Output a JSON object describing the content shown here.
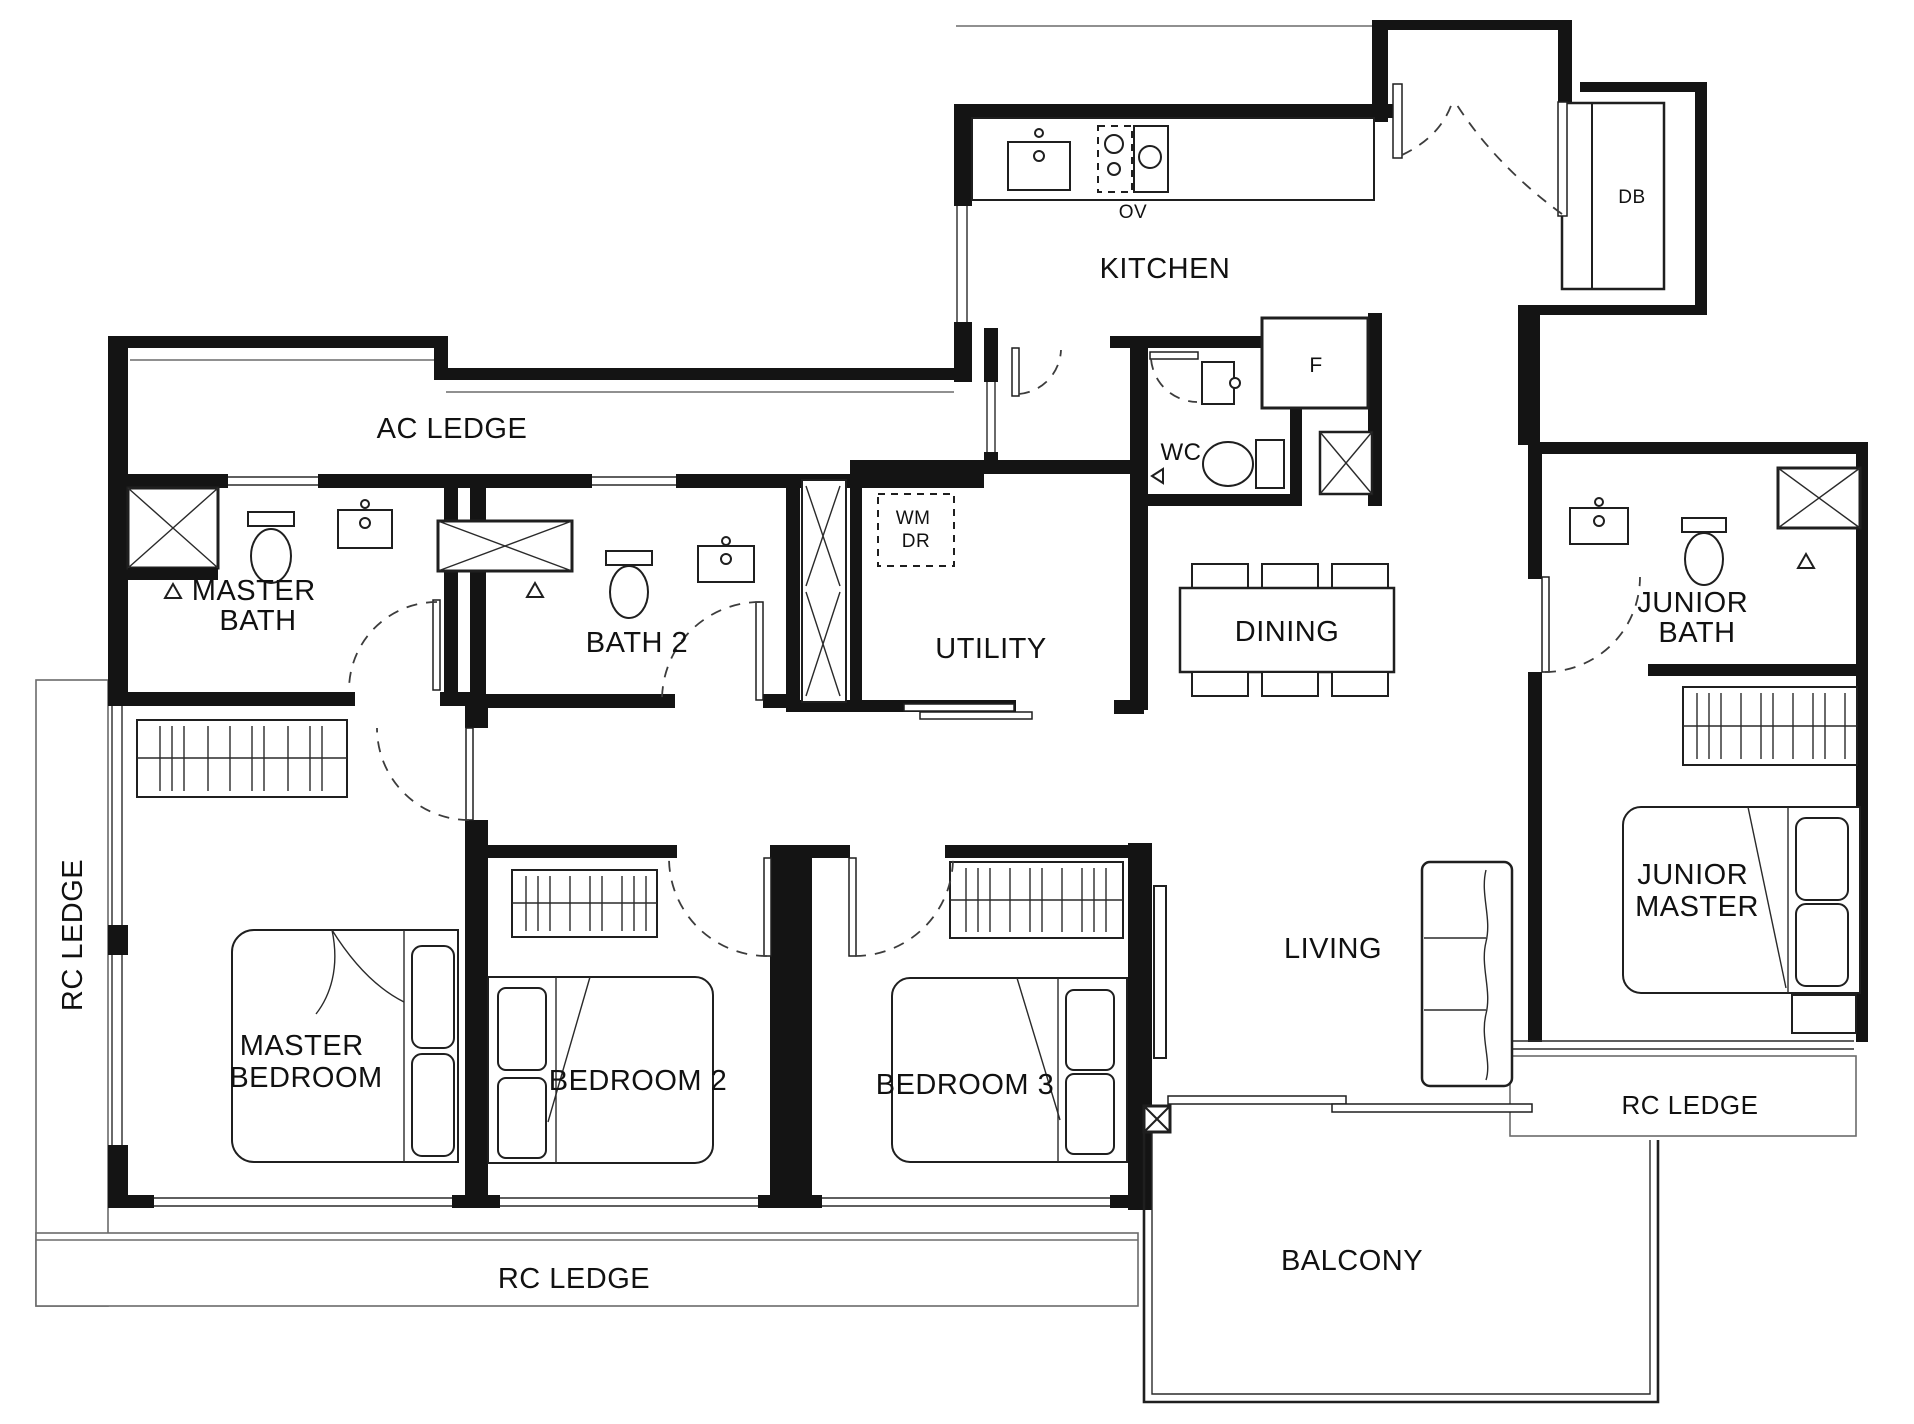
{
  "plan": {
    "rooms": {
      "ac_ledge": "AC LEDGE",
      "kitchen": "KITCHEN",
      "wc": "WC",
      "utility": "UTILITY",
      "dining": "DINING",
      "master_bath": [
        "MASTER",
        "BATH"
      ],
      "bath2": "BATH 2",
      "junior_bath": [
        "JUNIOR",
        "BATH"
      ],
      "master_bedroom": [
        "MASTER",
        "BEDROOM"
      ],
      "bedroom2": "BEDROOM 2",
      "bedroom3": "BEDROOM 3",
      "living": "LIVING",
      "junior_master": [
        "JUNIOR",
        "MASTER"
      ],
      "balcony": "BALCONY",
      "rc_ledge_left": "RC LEDGE",
      "rc_ledge_bottom": "RC LEDGE",
      "rc_ledge_right": "RC LEDGE"
    },
    "appliances": {
      "oven": "OV",
      "fridge": "F",
      "washer": "WM",
      "dryer": "DR",
      "distribution_board": "DB"
    },
    "fixtures": [
      "kitchen-counter",
      "kitchen-sink",
      "cooktop",
      "oven",
      "fridge",
      "distribution-board",
      "washer-dryer-stack",
      "duct-shaft",
      "shower",
      "toilet",
      "vanity-sink",
      "floor-trap",
      "dining-table",
      "dining-chair",
      "sofa",
      "tv-console",
      "wardrobe",
      "double-bed",
      "pillow",
      "bedside-table",
      "sliding-door",
      "swing-door",
      "window",
      "balcony-parapet"
    ],
    "colors": {
      "background": "#ffffff",
      "walls": "#141414",
      "fixture_line": "#1f1f1f",
      "ledge_line": "#6b6b6b",
      "door_dash": "#3c3c3c",
      "text": "#111111"
    }
  }
}
